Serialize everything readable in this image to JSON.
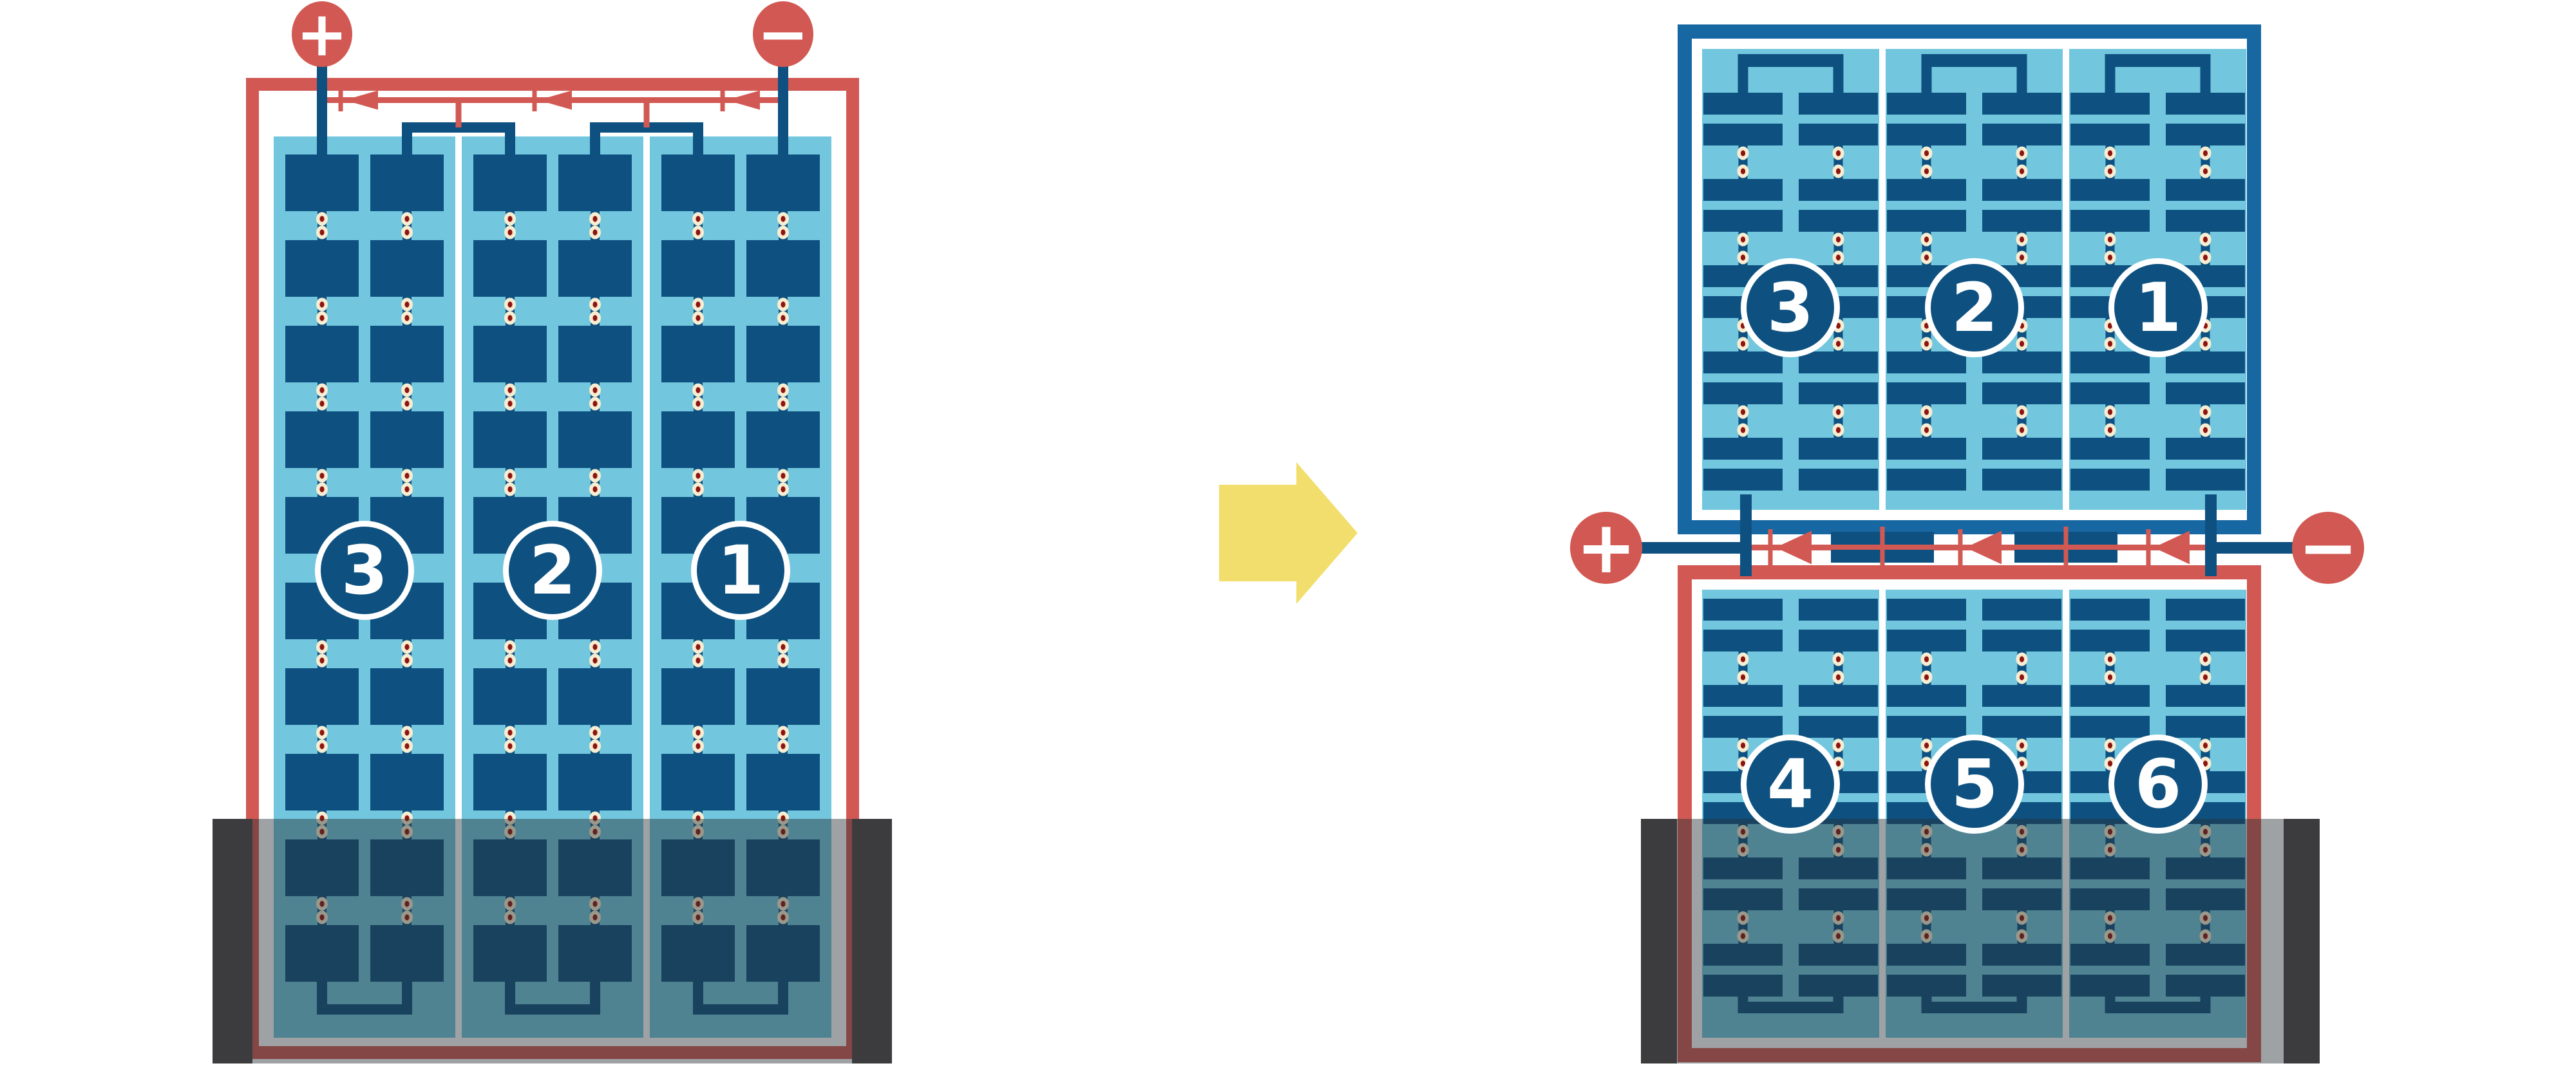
{
  "colors": {
    "background": "#FFFFFF",
    "red": "#D25953",
    "cell_blue": "#0E5180",
    "frame_blue": "#1767A3",
    "panel_light_blue": "#72C7DF",
    "solder_dot_cream": "#F7EDD2",
    "solder_dot_maroon": "#8E1410",
    "arrow_yellow": "#F2DE6C",
    "shade_overlay": "rgba(40,48,54,0.45)",
    "shade_bar_dark": "#3C3C3E",
    "text_white": "#FFFFFF"
  },
  "icons": {
    "transform_arrow": "right-arrow-icon",
    "positive_terminal": "plus-circle-icon",
    "negative_terminal": "minus-circle-icon",
    "bypass_diode": "left-pointing-diode-icon"
  },
  "left_module": {
    "terminals": {
      "positive": "+",
      "negative": "−"
    },
    "strings": [
      {
        "label": "3"
      },
      {
        "label": "2"
      },
      {
        "label": "1"
      }
    ],
    "bypass_diodes_count": 3,
    "shaded_bottom": true
  },
  "right_system": {
    "terminals": {
      "positive": "+",
      "negative": "−"
    },
    "top_module": {
      "strings": [
        {
          "label": "3"
        },
        {
          "label": "2"
        },
        {
          "label": "1"
        }
      ]
    },
    "bottom_module": {
      "strings": [
        {
          "label": "4"
        },
        {
          "label": "5"
        },
        {
          "label": "6"
        }
      ]
    },
    "bypass_diodes_count": 3,
    "shaded_bottom": true
  }
}
